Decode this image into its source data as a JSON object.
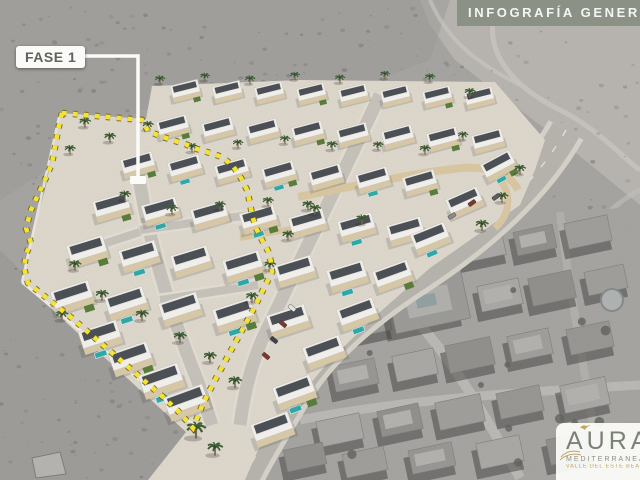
{
  "banner": {
    "title": "INFOGRAFÍA GENERAL"
  },
  "phase": {
    "label": "FASE 1"
  },
  "logo": {
    "brand": "AURA",
    "subtitle": "MEDITERRANEAN",
    "tagline": "VALLE DEL ESTE BEACH"
  },
  "palette": {
    "banner_bg": "#8b9185",
    "phase_text": "#5e6458",
    "boundary_yellow": "#f4e431",
    "boundary_outline": "#6b5e12",
    "leader_white": "#fbfbf9",
    "logo_gray": "#7b8177",
    "logo_gold": "#c2a45c",
    "terrain_gray": "#a5a3a0",
    "villa_white": "#f4f2ee",
    "villa_roof": "#474c52",
    "villa_terrace": "#d9c7a0",
    "pool_teal": "#2ba7a7",
    "palm_green": "#3a5a30",
    "road_gray": "#b6b3ad"
  }
}
